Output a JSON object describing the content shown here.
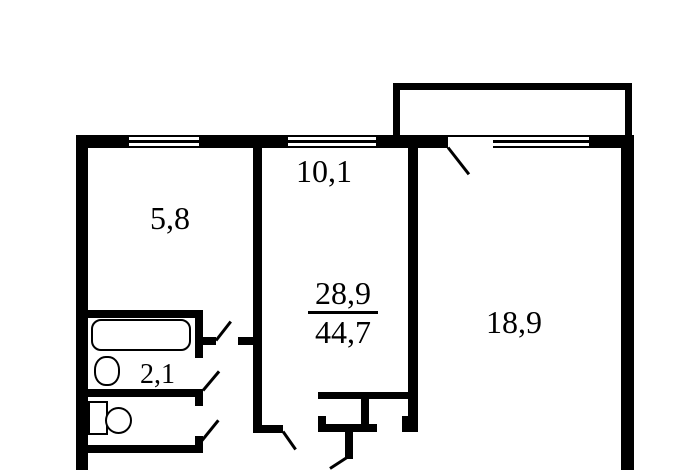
{
  "plan": {
    "rooms": {
      "kitchen": {
        "area_label": "5,8"
      },
      "room_small": {
        "area_label": "10,1"
      },
      "room_large": {
        "area_label": "18,9"
      },
      "bathroom": {
        "area_label": "2,1"
      }
    },
    "summary": {
      "living_area": "28,9",
      "total_area": "44,7"
    },
    "colors": {
      "wall": "#000000",
      "background": "#ffffff"
    }
  }
}
